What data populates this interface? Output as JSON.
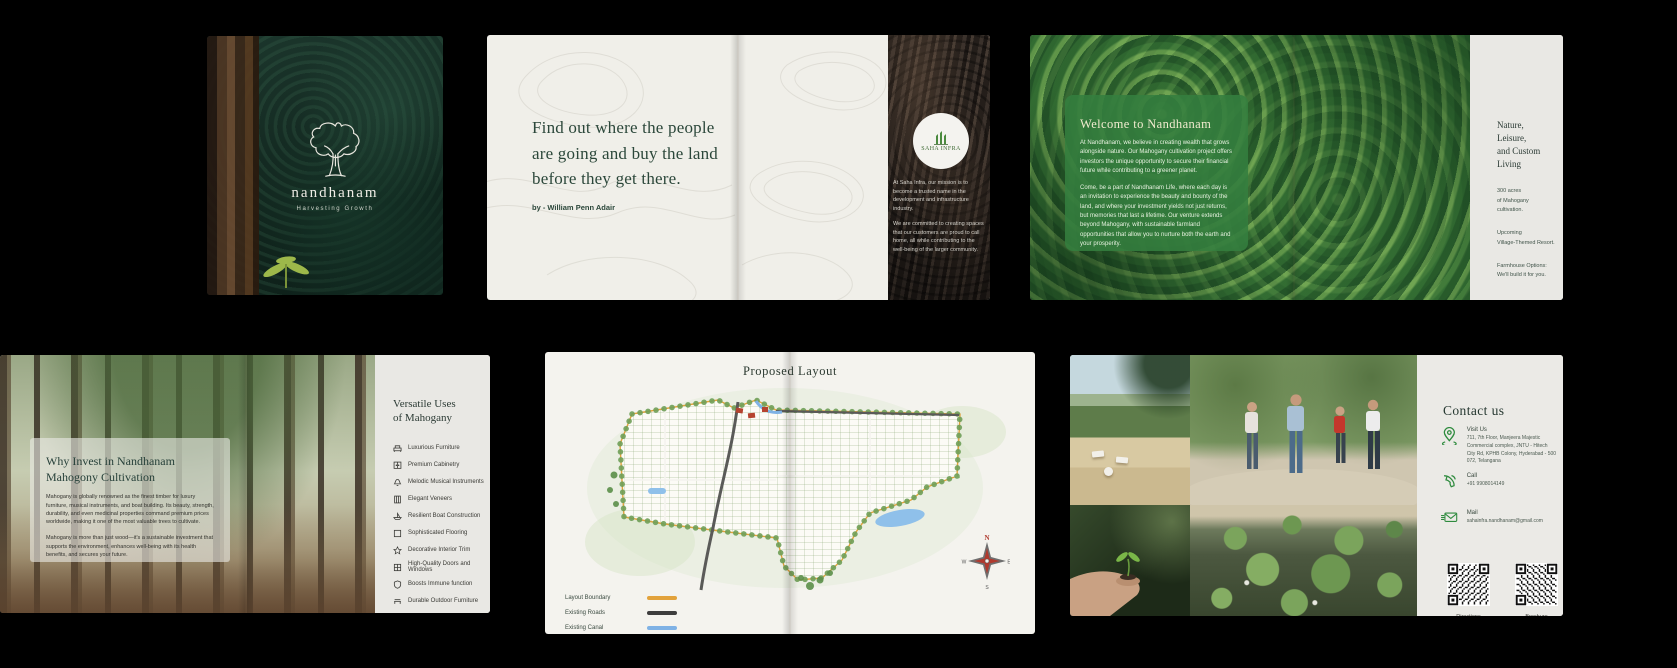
{
  "cover": {
    "brand": "nandhanam",
    "tagline": "Harvesting Growth"
  },
  "quote_spread": {
    "quote": "Find out where the people are going and buy the land before they get there.",
    "attribution": "by - William Penn Adair",
    "partner": {
      "logo_text": "SAHA INFRA",
      "mission_p1": "At Saha Infra, our mission is to become a trusted name in the development and infrastructure industry.",
      "mission_p2": "We are committed to creating spaces that our customers are proud to call home, all while contributing to the well-being of the larger community."
    }
  },
  "welcome_spread": {
    "title": "Welcome to Nandhanam",
    "p1": "At Nandhanam, we believe in creating wealth that grows alongside nature. Our Mahogany cultivation project offers investors the unique opportunity to secure their financial future while contributing to a greener planet.",
    "p2": "Come, be a part of Nandhanam Life, where each day is an invitation to experience the beauty and bounty of the land, and where your investment yields not just returns, but memories that last a lifetime. Our venture extends beyond Mahogany, with sustainable farmland opportunities that allow you to nurture both the earth and your prosperity.",
    "right_panel": {
      "heading_line1": "Nature, Leisure,",
      "heading_line2": "and Custom Living",
      "items": [
        {
          "line1": "300 acres",
          "line2": "of Mahogany cultivation."
        },
        {
          "line1": "Upcoming",
          "line2": "Village-Themed Resort."
        },
        {
          "line1": "Farmhouse Options:",
          "line2": "We'll build it for you."
        }
      ]
    }
  },
  "invest_spread": {
    "overlay": {
      "heading_line1": "Why Invest in Nandhanam",
      "heading_line2": "Mahogony Cultivation",
      "p1": "Mahogany is globally renowned as the finest timber for luxury furniture, musical instruments, and boat building. Its beauty, strength, durability, and even medicinal properties command premium prices worldwide, making it one of the most valuable trees to cultivate.",
      "p2": "Mahogany is more than just wood—it's a sustainable investment that supports the environment, enhances well-being with its health benefits, and secures your future."
    },
    "uses": {
      "heading_line1": "Versatile Uses",
      "heading_line2": "of Mahogany",
      "items": [
        {
          "icon": "sofa-icon",
          "label": "Luxurious Furniture"
        },
        {
          "icon": "cabinet-icon",
          "label": "Premium Cabinetry"
        },
        {
          "icon": "bell-icon",
          "label": "Melodic Musical Instruments"
        },
        {
          "icon": "veneer-icon",
          "label": "Elegant Veneers"
        },
        {
          "icon": "boat-icon",
          "label": "Resilient Boat Construction"
        },
        {
          "icon": "flooring-icon",
          "label": "Sophisticated Flooring"
        },
        {
          "icon": "star-icon",
          "label": "Decorative Interior Trim"
        },
        {
          "icon": "window-icon",
          "label": "High-Quality Doors and Windows"
        },
        {
          "icon": "shield-icon",
          "label": "Boosts Immune function"
        },
        {
          "icon": "bench-icon",
          "label": "Durable Outdoor Furniture"
        }
      ]
    }
  },
  "layout_spread": {
    "title": "Proposed Layout",
    "legend": [
      {
        "label": "Layout Boundary",
        "color": "#E2A23B"
      },
      {
        "label": "Existing Roads",
        "color": "#3D3D3D"
      },
      {
        "label": "Existing Canal",
        "color": "#7FB2E5"
      }
    ],
    "compass": {
      "n": "N",
      "e": "E",
      "s": "S",
      "w": "W"
    }
  },
  "contact_spread": {
    "heading": "Contact us",
    "items": [
      {
        "icon": "location-pin-icon",
        "label": "Visit Us",
        "value": "711, 7th Floor, Manjeera Majestic Commercial complex, JNTU - Hitech City Rd, KPHB Colony, Hyderabad - 500 072, Telangana"
      },
      {
        "icon": "phone-icon",
        "label": "Call",
        "value": "+91 9908014149"
      },
      {
        "icon": "mail-icon",
        "label": "Mail",
        "value": "sahainfra.nandhanam@gmail.com"
      }
    ],
    "qr": [
      {
        "label": "Directions"
      },
      {
        "label": "Brochure"
      }
    ]
  },
  "colors": {
    "deep_green": "#2B473A",
    "overlay_green": "#347E3F",
    "accent_green": "#2E8B3E",
    "boundary_orange": "#E2A23B",
    "road_dark": "#3D3D3D",
    "canal_blue": "#7FB2E5"
  }
}
